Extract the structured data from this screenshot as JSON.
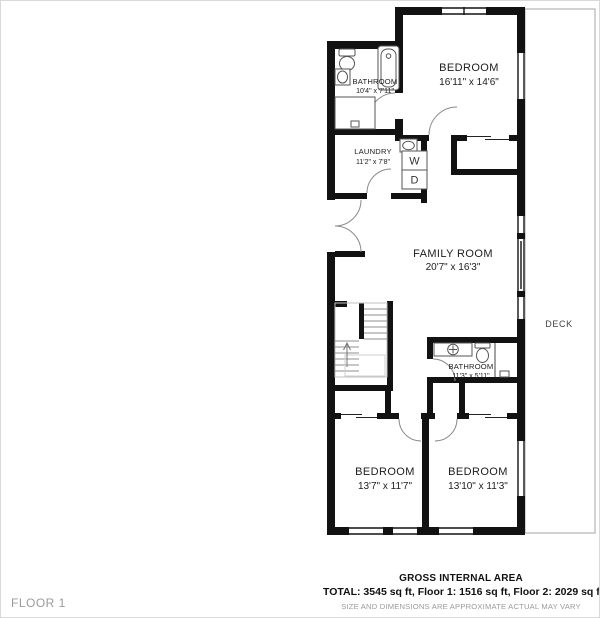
{
  "floor_label": "FLOOR 1",
  "rooms": [
    {
      "name": "BATHROOM",
      "dims": "10'4\" x 7'11\""
    },
    {
      "name": "BEDROOM",
      "dims": "16'11\" x 14'6\""
    },
    {
      "name": "LAUNDRY",
      "dims": "11'2\" x 7'8\""
    },
    {
      "name": "FAMILY ROOM",
      "dims": "20'7\" x 16'3\""
    },
    {
      "name": "BATHROOM",
      "dims": "11'3\" x 5'11\""
    },
    {
      "name": "BEDROOM",
      "dims": "13'7\" x 11'7\""
    },
    {
      "name": "BEDROOM",
      "dims": "13'10\" x 11'3\""
    }
  ],
  "deck_label": "DECK",
  "appliances": {
    "washer": "W",
    "dryer": "D"
  },
  "footer": {
    "title": "GROSS INTERNAL AREA",
    "totals": "TOTAL: 3545 sq ft, Floor 1: 1516 sq ft, Floor 2: 2029 sq ft",
    "disclaimer": "SIZE AND DIMENSIONS ARE APPROXIMATE ACTUAL MAY VARY"
  }
}
